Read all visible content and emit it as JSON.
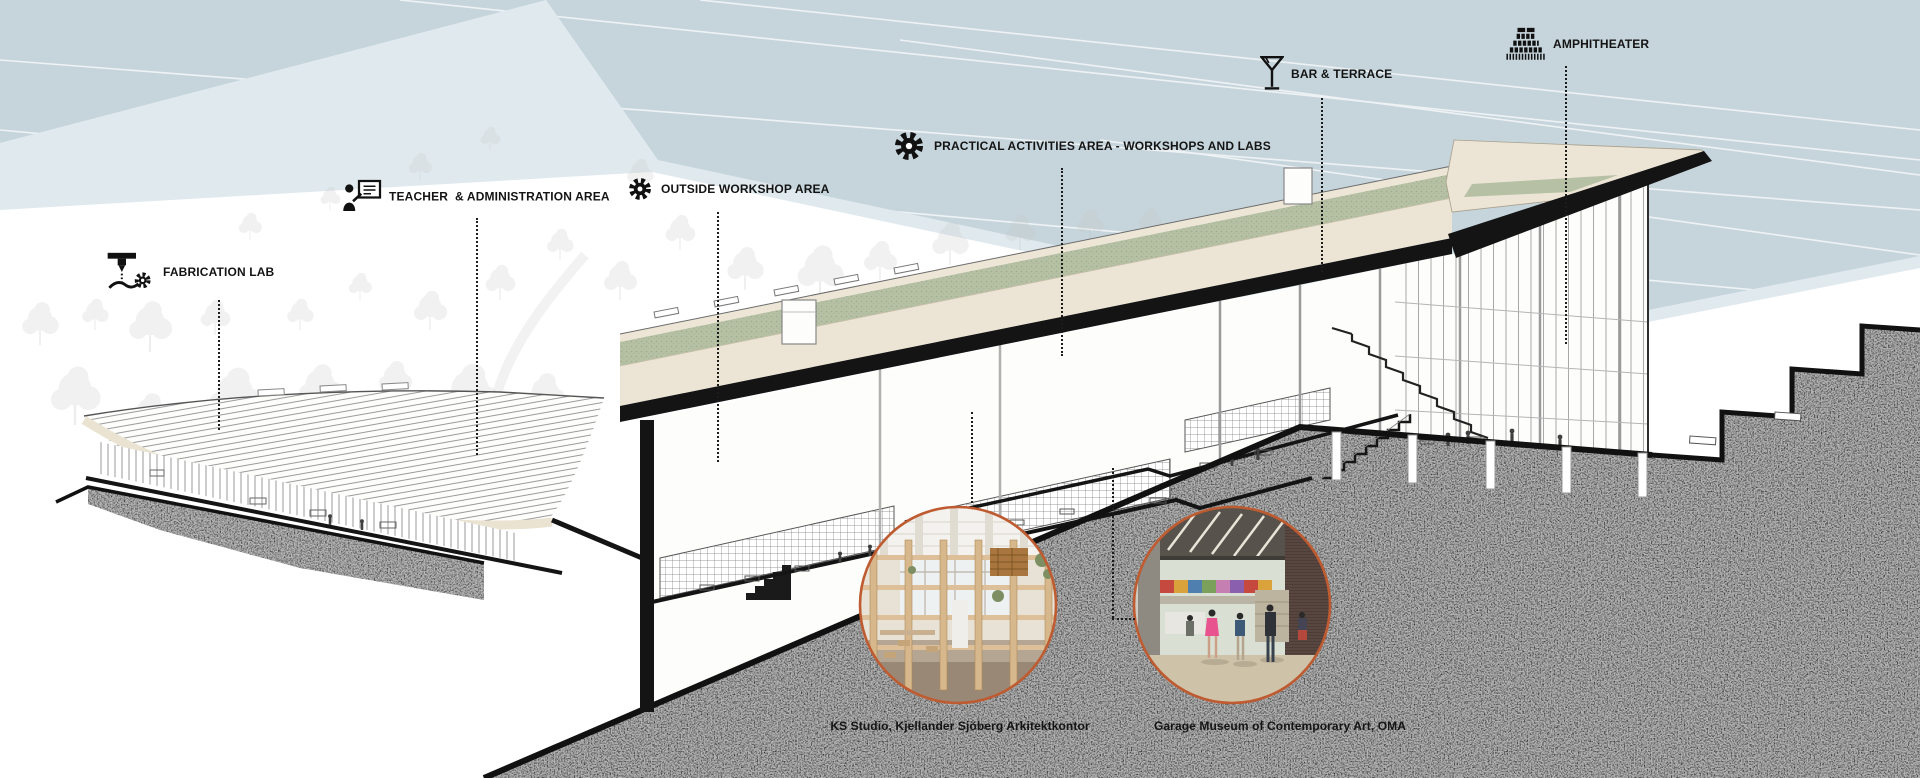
{
  "diagram": {
    "type": "architectural sectional axonometric",
    "labels": {
      "fabrication_lab": {
        "text": "FABRICATION LAB",
        "icon": "fabrication-machine-icon"
      },
      "teacher_admin": {
        "text": "TEACHER  & ADMINISTRATION AREA",
        "icon": "presenter-board-icon"
      },
      "outside_workshop": {
        "text": "OUTSIDE WORKSHOP AREA",
        "icon": "gear-icon"
      },
      "practical_activities": {
        "text": "PRACTICAL ACTIVITIES AREA - WORKSHOPS AND LABS",
        "icon": "gear-icon"
      },
      "bar_terrace": {
        "text": "BAR & TERRACE",
        "icon": "cocktail-glass-icon"
      },
      "amphitheater": {
        "text": "AMPHITHEATER",
        "icon": "amphitheater-tiers-icon"
      }
    },
    "references": {
      "left": {
        "caption": "KS Studio, Kjellander Sjöberg Arkitektkontor"
      },
      "right": {
        "caption": "Garage Museum of Contemporary Art, OMA"
      }
    },
    "colors": {
      "sky": "#c6d5dc",
      "sky_light": "#e0eaee",
      "roof_cream": "#ece5d6",
      "roof_green": "#b6c0a4",
      "ground_gray": "#b5b5b5",
      "ink": "#161616",
      "photo_ring": "#bf5b30"
    }
  }
}
